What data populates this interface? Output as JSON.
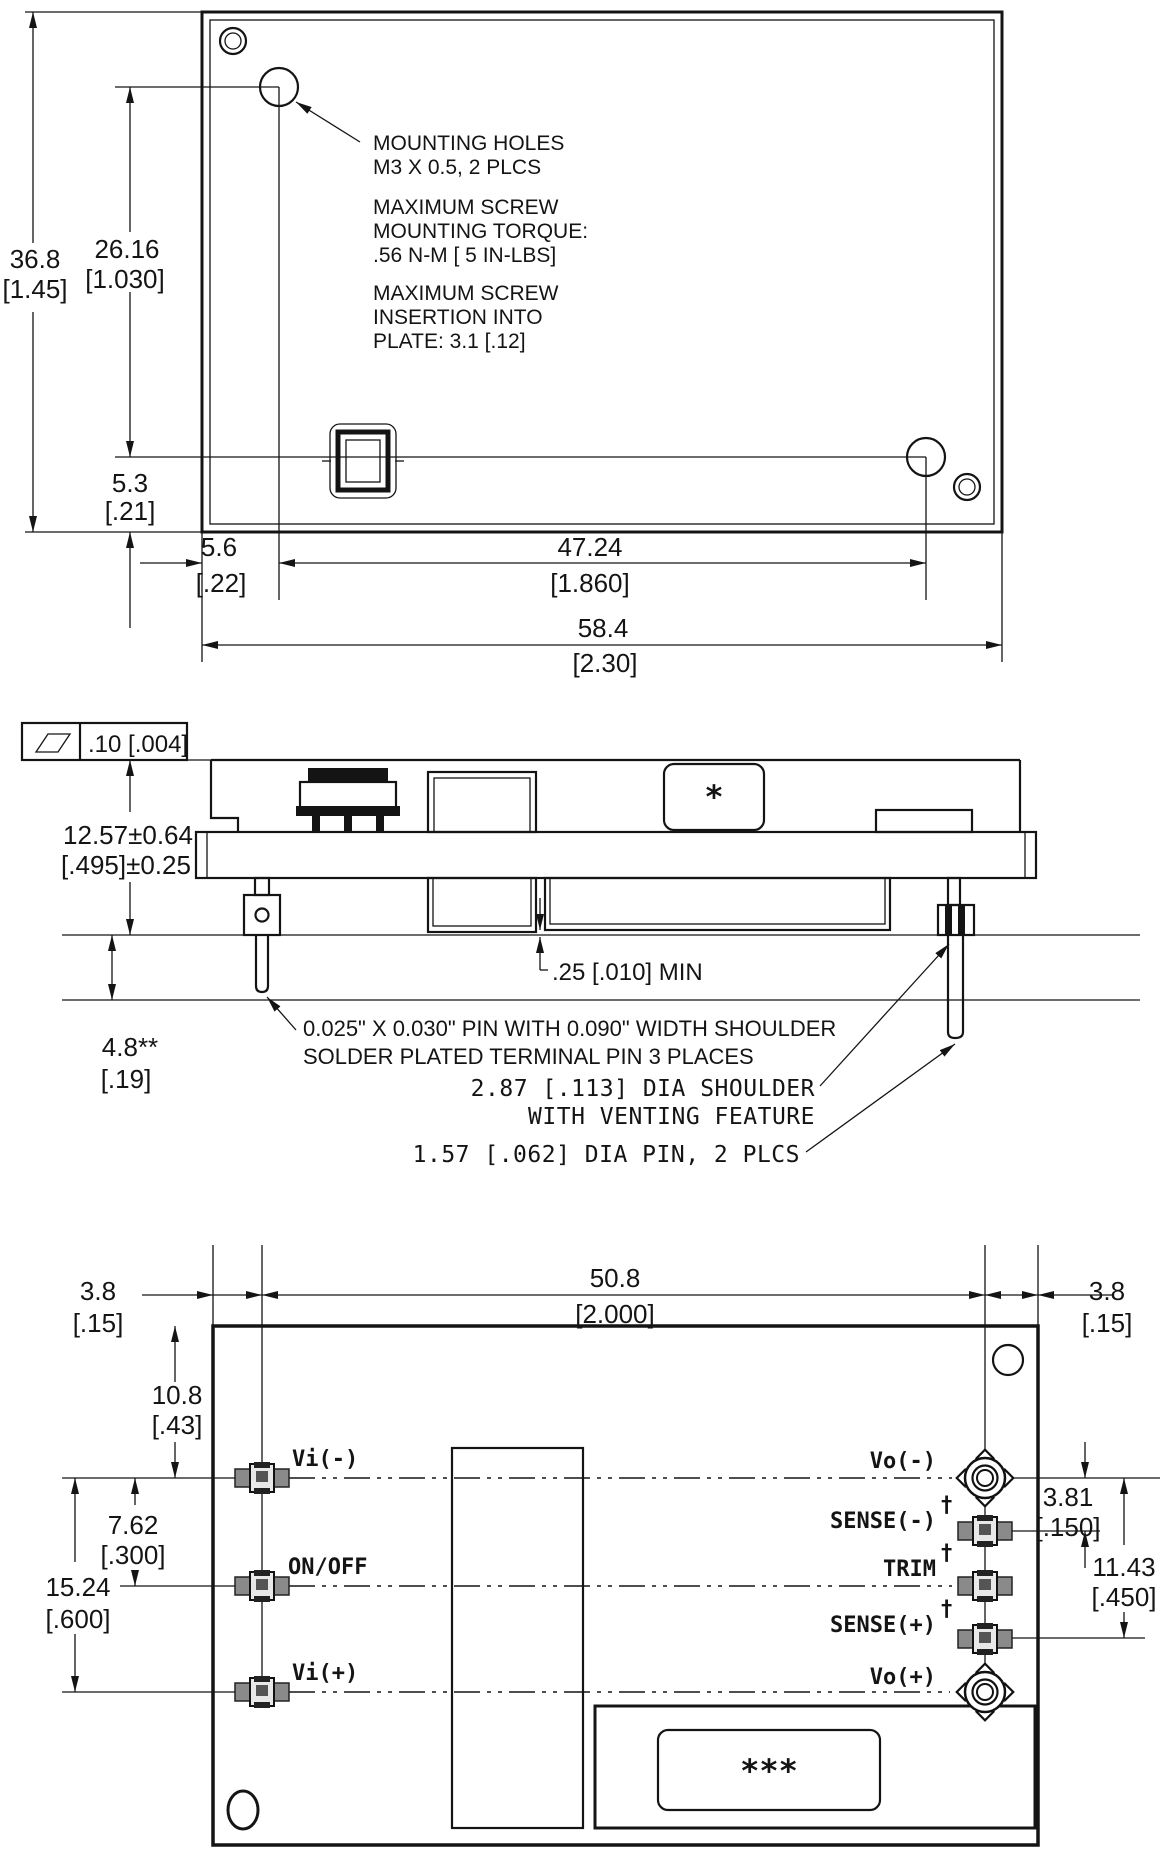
{
  "title": "Power module outline drawing",
  "colors": {
    "line": "#141414",
    "background": "#ffffff",
    "pin_dark": "#333333",
    "pin_mid": "#777777",
    "pin_light": "#bbbbbb"
  },
  "top_view": {
    "dims": {
      "height": [
        "36.8",
        "[1.45]"
      ],
      "hole_span_vertical": [
        "26.16",
        "[1.030]"
      ],
      "hole_to_bottom": [
        "5.3",
        "[.21]"
      ],
      "edge_to_hole": [
        "5.6",
        "[.22]"
      ],
      "hole_span_horizontal": [
        "47.24",
        "[1.860]"
      ],
      "width": [
        "58.4",
        "[2.30]"
      ]
    },
    "notes": {
      "mounting_holes": [
        "MOUNTING HOLES",
        "M3 X 0.5, 2 PLCS"
      ],
      "torque": [
        "MAXIMUM SCREW",
        "MOUNTING TORQUE:",
        ".56 N-M [ 5 IN-LBS]"
      ],
      "insertion": [
        "MAXIMUM SCREW",
        "INSERTION INTO",
        "PLATE: 3.1 [.12]"
      ]
    }
  },
  "side_view": {
    "flatness": ".10 [.004]",
    "dims": {
      "height": [
        "12.57±0.64",
        "[.495]±0.25"
      ],
      "pin_length": [
        "4.8**",
        "[.19]"
      ],
      "clearance": ".25 [.010] MIN"
    },
    "notes": {
      "terminal_pin": [
        "0.025\" X 0.030\" PIN WITH 0.090\" WIDTH SHOULDER",
        "SOLDER PLATED TERMINAL PIN  3 PLACES"
      ],
      "shoulder": [
        "2.87 [.113] DIA SHOULDER",
        "WITH VENTING FEATURE"
      ],
      "dia_pin": "1.57 [.062] DIA PIN, 2 PLCS"
    },
    "marker": "*"
  },
  "bottom_view": {
    "dims": {
      "left_margin": [
        "3.8",
        "[.15]"
      ],
      "pin_span": [
        "50.8",
        "[2.000]"
      ],
      "right_margin": [
        "3.8",
        "[.15]"
      ],
      "top_to_first_pin": [
        "10.8",
        "[.43]"
      ],
      "row_pitch": [
        "7.62",
        "[.300]"
      ],
      "row_span": [
        "15.24",
        "[.600]"
      ],
      "sense_offset": [
        "3.81",
        "[.150]"
      ],
      "sense_span": [
        "11.43",
        "[.450]"
      ]
    },
    "pins_left": [
      "Vi(-)",
      "ON/OFF",
      "Vi(+)"
    ],
    "pins_right": [
      "Vo(-)",
      "SENSE(-)",
      "TRIM",
      "SENSE(+)",
      "Vo(+)"
    ],
    "dagger": "†",
    "marker": "***"
  }
}
